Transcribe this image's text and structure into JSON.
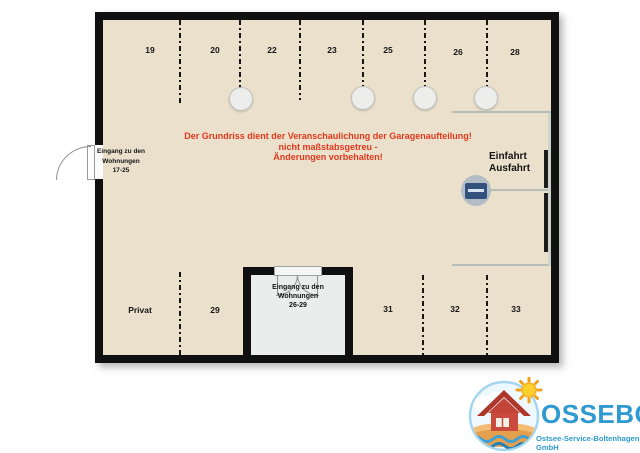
{
  "colors": {
    "floor": "#eae0cc",
    "wall": "#101010",
    "room_floor": "#e9edec",
    "lane_line": "#b6bcb7",
    "warning_text": "#e0391c",
    "logo_blue": "#2e9ad0"
  },
  "plan": {
    "top_spaces": [
      "19",
      "20",
      "22",
      "23",
      "25",
      "26",
      "28"
    ],
    "bottom_spaces": [
      "Privat",
      "29",
      "31",
      "32",
      "33"
    ],
    "warning": {
      "line1": "Der Grundriss dient der Veranschaulichung der Garagenaufteilung!",
      "line2": "nicht maßstabsgetreu -",
      "line3": "Änderungen vorbehalten!"
    },
    "entrance_exit": {
      "line1": "Einfahrt",
      "line2": "Ausfahrt"
    },
    "apartments_door_left": {
      "line1": "Eingang zu den",
      "line2": "Wohnungen",
      "line3": "17-25"
    },
    "apartments_door_room": {
      "line1": "Eingang zu den",
      "line2": "Wohnungen",
      "line3": "26-29"
    }
  },
  "logo": {
    "name": "OSSEBO",
    "subtitle": "Ostsee-Service-Boltenhagen GmbH"
  }
}
